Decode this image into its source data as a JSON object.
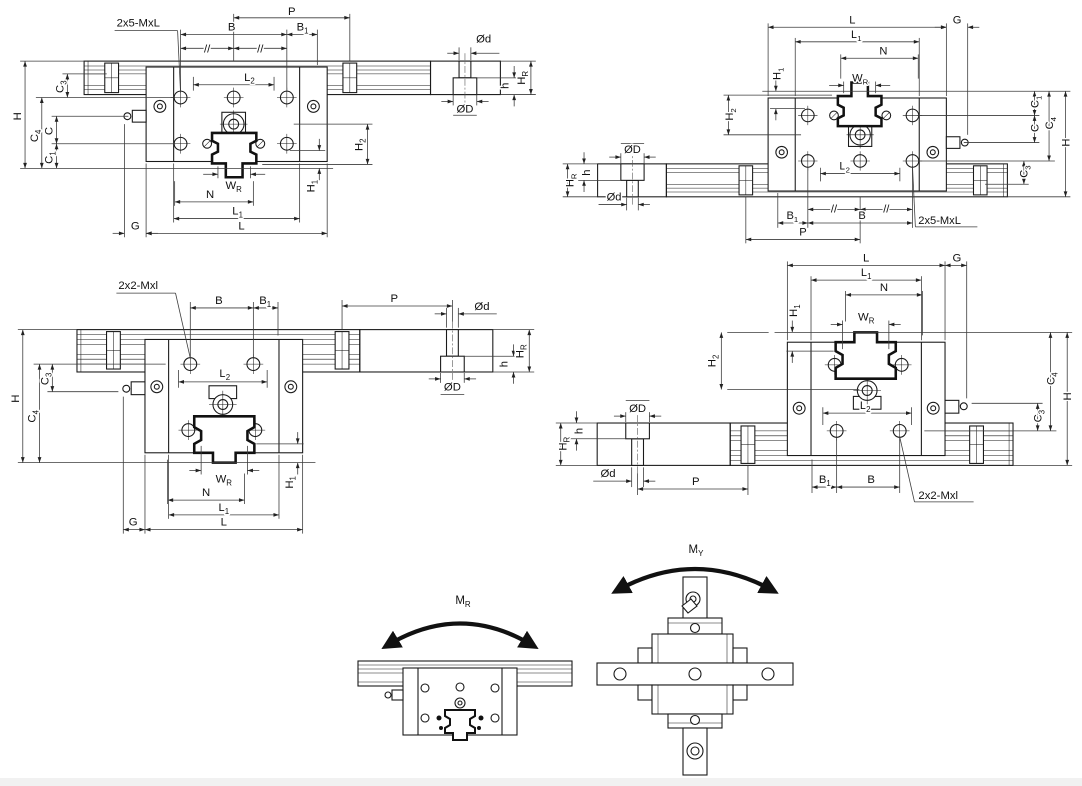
{
  "page": {
    "background": "#ffffff",
    "footer_bar_color": "#f1f1f1",
    "line_color": "#1a1a1a"
  },
  "dims": {
    "P": {
      "b": "P",
      "s": ""
    },
    "B": {
      "b": "B",
      "s": ""
    },
    "B1": {
      "b": "B",
      "s": "1"
    },
    "L": {
      "b": "L",
      "s": ""
    },
    "L1": {
      "b": "L",
      "s": "1"
    },
    "L2": {
      "b": "L",
      "s": "2"
    },
    "N": {
      "b": "N",
      "s": ""
    },
    "WR": {
      "b": "W",
      "s": "R"
    },
    "G": {
      "b": "G",
      "s": ""
    },
    "H": {
      "b": "H",
      "s": ""
    },
    "H1": {
      "b": "H",
      "s": "1"
    },
    "H2": {
      "b": "H",
      "s": "2"
    },
    "HR": {
      "b": "H",
      "s": "R"
    },
    "h": {
      "b": "h",
      "s": ""
    },
    "C": {
      "b": "C",
      "s": ""
    },
    "C1": {
      "b": "C",
      "s": "1"
    },
    "C3": {
      "b": "C",
      "s": "3"
    },
    "C4": {
      "b": "C",
      "s": "4"
    },
    "od": {
      "b": "Ød",
      "s": ""
    },
    "OD": {
      "b": "ØD",
      "s": ""
    },
    "parallel": {
      "b": "//",
      "s": ""
    }
  },
  "callouts": {
    "top_assemblies": "2x5-MxL",
    "middle_assemblies": "2x2-Mxl"
  },
  "moments": {
    "MR": {
      "b": "M",
      "s": "R"
    },
    "MY": {
      "b": "M",
      "s": "Y"
    }
  }
}
